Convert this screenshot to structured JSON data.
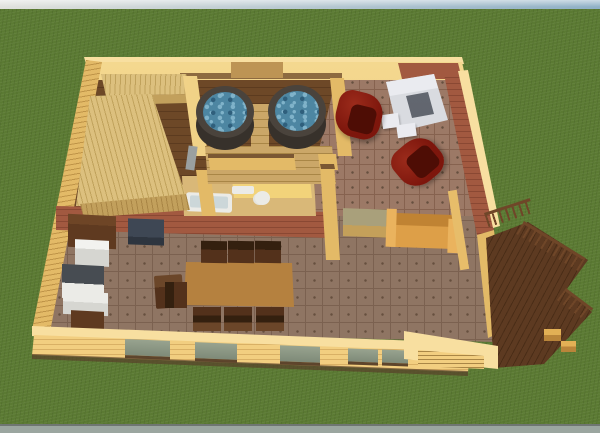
{
  "scene": {
    "title": "3D bird's-eye rendering of a sauna cottage floor plan",
    "background": {
      "sky": "pale horizon strip",
      "ground": "green lawn",
      "road": "gray strip along bottom edge"
    },
    "rooms": [
      {
        "name": "sauna",
        "features": [
          "L-shaped tiered wooden benches",
          "dark wood plank floor",
          "gray glass door"
        ]
      },
      {
        "name": "hot-tub-room",
        "features": [
          "two round hot tubs with blue water",
          "wooden steps between tubs",
          "wooden platform"
        ]
      },
      {
        "name": "fireplace-lounge",
        "features": [
          "white stone fireplace",
          "two dark red armchairs",
          "red brick walls",
          "tile floor"
        ]
      },
      {
        "name": "bathroom",
        "features": [
          "white bathtub",
          "toilet",
          "sink",
          "bright yellow walls"
        ]
      },
      {
        "name": "kitchen",
        "features": [
          "white refrigerator",
          "dark countertop units",
          "dark island",
          "wooden chair"
        ]
      },
      {
        "name": "dining-area",
        "features": [
          "long wooden table",
          "seven dark brown chairs"
        ]
      },
      {
        "name": "sitting-area",
        "features": [
          "tan sofa",
          "sage-topped side table"
        ]
      },
      {
        "name": "deck",
        "features": [
          "dark wood planks",
          "railing with slats",
          "two stools",
          "entry steps"
        ]
      }
    ],
    "window_count": 5,
    "hot_tub_count": 2
  },
  "colors": {
    "sky-left": "#e0e1dc",
    "sky-right": "#8fb0c6",
    "grass": "#5b7a33",
    "road": "#9ba6a0",
    "road-line": "#6f7672",
    "wall-cap": "#f8dfa0",
    "wall-top": "#f2ce80",
    "wall-light": "#f7dd96",
    "wall-mid": "#e3ba67",
    "wall-shade": "#c99953",
    "siding-line": "#bf9448",
    "wood-floor": "#6d4827",
    "wood-line": "#5c3b1f",
    "bench": "#dcc07e",
    "bench-line": "#c0a25c",
    "bench-shade": "#c2a05c",
    "tub-rim": "#4a433c",
    "tub-side": "#37312b",
    "water": "#4d86a2",
    "water-light": "#7fb2c9",
    "water-dark": "#2f5f7c",
    "step-tan": "#cba768",
    "step-line": "#a98646",
    "brick": "#a25940",
    "brick-line": "#8a4833",
    "tile-fire": "#9c7966",
    "tile-fire-line": "#86624f",
    "tile-main": "#8f7563",
    "tile-main-line": "#7b6150",
    "tile-dot": "#66503f",
    "fireplace": "#d9dbe0",
    "fireplace-light": "#eaebf0",
    "firebox": "#686d76",
    "firebox-dark": "#4e525a",
    "chair-red": "#7d160c",
    "chair-red-dark": "#4e0d05",
    "chair-red-light": "#9b2b1b",
    "table-brown": "#b5813f",
    "table-edge": "#8f5f28",
    "chair-brown": "#53311b",
    "chair-brown-dark": "#34200f",
    "chair-brown-mid": "#6b4629",
    "white": "#ebebe7",
    "white-shade": "#d6d6d1",
    "counter-top": "#474c52",
    "island-top": "#3e4754",
    "island-side": "#2e353f",
    "cabinet-dark": "#5f3a20",
    "cabinet-top": "#6e4526",
    "sofa-tan": "#dd9f48",
    "sofa-tan-dark": "#c08333",
    "sofa-tan-light": "#eab35e",
    "sage-top": "#a9a07b",
    "deck": "#5d3a21",
    "deck-line": "#4a2d17",
    "rail": "#6f4628",
    "bath-yellow": "#f2d37a",
    "bath-yellow-shade": "#d8b55c",
    "bath-floor": "#d9b878",
    "glass": "#98a38f",
    "glass-dark": "#7e8a78",
    "sill": "#5e452c",
    "door-inset": "#bd9454",
    "door-gray": "#9aa0a0",
    "ledge": "#7a5733",
    "front-shadow": "#58402a"
  }
}
